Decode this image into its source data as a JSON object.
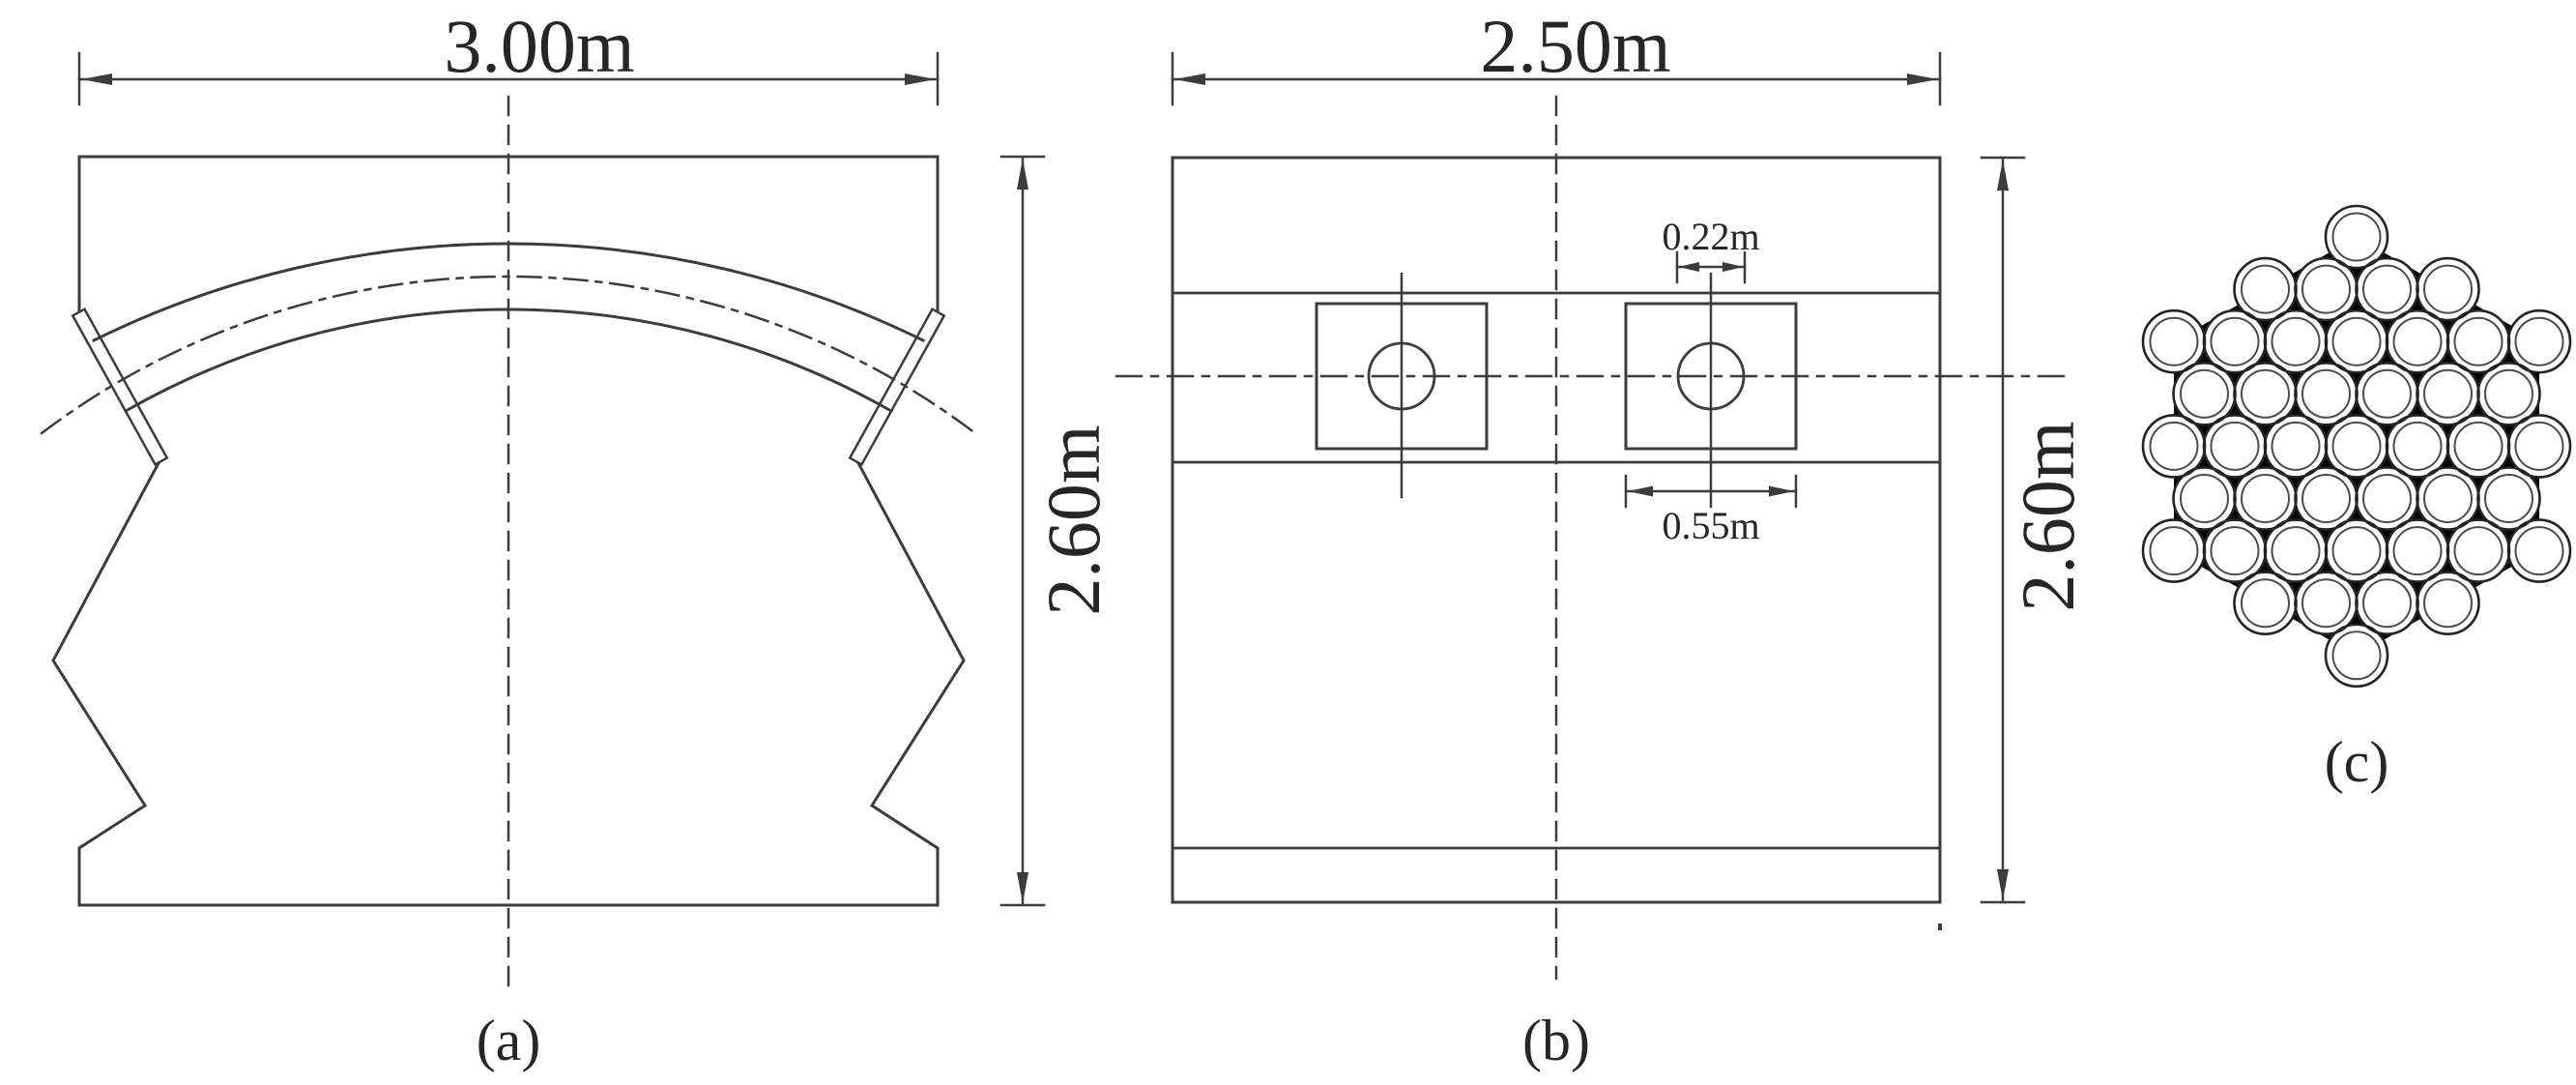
{
  "drawing": {
    "description": "Three-part structural engineering figure: arch cross-section, anchor elevation, strand bundle",
    "colors": {
      "line": "#3c3c3c",
      "text": "#262626",
      "background": "#ffffff",
      "strand_gap_fill": "#000000"
    },
    "panel_a": {
      "label": "(a)",
      "width_label": "3.00m",
      "height_label": "2.60m"
    },
    "panel_b": {
      "label": "(b)",
      "width_label": "2.50m",
      "height_label": "2.60m",
      "hole_label": "0.22m",
      "anchor_label": "0.55m"
    },
    "panel_c": {
      "label": "(c)",
      "strand_rows": [
        1,
        4,
        7,
        6,
        7,
        6,
        7,
        4,
        1
      ],
      "strand_count": 43
    }
  }
}
